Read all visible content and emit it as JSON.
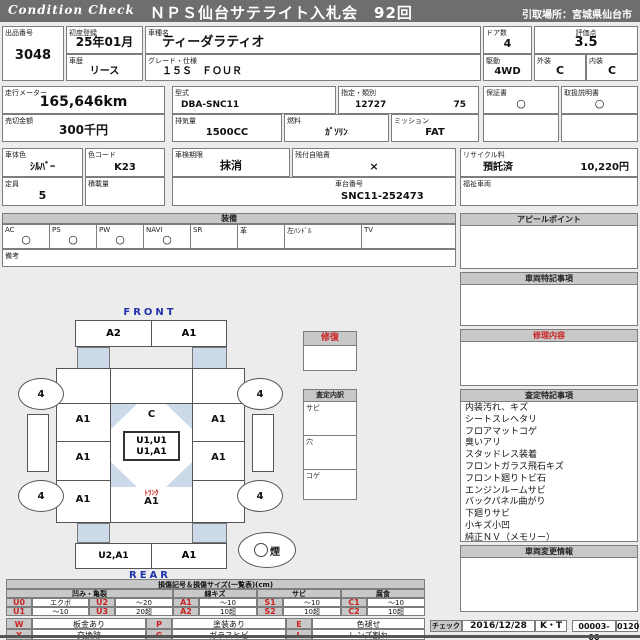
{
  "header": {
    "logo": "Condition Check",
    "title": "ＮＰＳ仙台サテライト入札会　92回",
    "pickup": "引取場所：宮城県仙台市"
  },
  "fields": {
    "lot_no": {
      "label": "出品番号",
      "value": "3048"
    },
    "first_registration": {
      "label": "初度登録",
      "value": "25年01月"
    },
    "car_history": {
      "label": "車歴",
      "value": "リース"
    },
    "model_name": {
      "label": "車種名",
      "value": "ティーダラティオ"
    },
    "grade": {
      "label": "グレード・仕様",
      "value": "１５Ｓ　ＦＯＵＲ"
    },
    "doors": {
      "label": "ドア数",
      "value": "4"
    },
    "score": {
      "label": "評価点",
      "value": "3.5"
    },
    "drive": {
      "label": "駆動",
      "value": "4WD"
    },
    "exterior_grade": {
      "label": "外装",
      "value": "C"
    },
    "interior_grade": {
      "label": "内装",
      "value": "C"
    },
    "odometer": {
      "label": "走行メーター",
      "value": "165,646km"
    },
    "sellout_price": {
      "label": "売切金額",
      "value": "300千円"
    },
    "model_code": {
      "label": "型式",
      "value": "DBA-SNC11"
    },
    "class_no": {
      "label": "指定・類別",
      "designation": "12727",
      "class": "75"
    },
    "warranty_book": {
      "label": "保証書",
      "value": "○"
    },
    "owners_manual": {
      "label": "取扱説明書",
      "value": "○"
    },
    "displacement": {
      "label": "排気量",
      "value": "1500CC"
    },
    "fuel": {
      "label": "燃料",
      "value": "ｶﾞｿﾘﾝ"
    },
    "transmission": {
      "label": "ミッション",
      "value": "FAT"
    },
    "body_color": {
      "label": "車体色",
      "value": "ｼﾙﾊﾞｰ"
    },
    "color_code": {
      "label": "色コード",
      "value": "K23"
    },
    "inspection_expiry": {
      "label": "車検期限",
      "value": "抹消"
    },
    "liability_insurance": {
      "label": "残付自賠責",
      "value": "×"
    },
    "seating": {
      "label": "定員",
      "value": "5"
    },
    "load_capacity": {
      "label": "積載量",
      "value": ""
    },
    "chassis_no": {
      "label": "車台番号",
      "value": "SNC11-252473"
    },
    "recycle_fee": {
      "label": "リサイクル料",
      "status": "預託済",
      "value": "10,220円"
    },
    "welfare_vehicle": {
      "label": "福祉車両",
      "value": ""
    }
  },
  "equipment": {
    "title": "装備",
    "remarks_label": "備考",
    "items": [
      {
        "label": "AC",
        "value": "○"
      },
      {
        "label": "PS",
        "value": "○"
      },
      {
        "label": "PW",
        "value": "○"
      },
      {
        "label": "NAVI",
        "value": "○"
      },
      {
        "label": "SR",
        "value": ""
      },
      {
        "label": "革",
        "value": ""
      },
      {
        "label": "左ﾊﾝﾄﾞﾙ",
        "value": ""
      },
      {
        "label": "TV",
        "value": ""
      }
    ]
  },
  "sections": {
    "appeal": {
      "title": "アピールポイント",
      "body": ""
    },
    "vehicle_notes": {
      "title": "車両特記事項",
      "body": ""
    },
    "repair": {
      "title": "修理内容",
      "body": ""
    },
    "assessment": {
      "title": "査定特記事項",
      "lines": [
        "内装汚れ、キズ",
        "シートスレヘタリ",
        "フロアマットコゲ",
        "臭いアリ",
        "スタッドレス装着",
        "フロントガラス飛石キズ",
        "フロント廻りトビ石",
        "エンジンルームサビ",
        "バックパネル曲がり",
        "下廻りサビ",
        "小キズ小凹",
        "純正ＮＶ（メモリー）"
      ]
    },
    "change_info": {
      "title": "車両変更情報",
      "body": ""
    },
    "repair_history": {
      "title": "修復"
    },
    "assessment_detail": {
      "title": "査定内訳",
      "rows": [
        "サビ",
        "穴",
        "コゲ"
      ]
    }
  },
  "diagram": {
    "front_label": "FRONT",
    "rear_label": "REAR",
    "front_bumper_left": "A2",
    "front_bumper_right": "A1",
    "tire_front_left": "4",
    "tire_front_right": "4",
    "tire_rear_left": "4",
    "tire_rear_right": "4",
    "left_panels": [
      "A1",
      "A1",
      "A1"
    ],
    "right_panels": [
      "A1",
      "A1"
    ],
    "roof": "C",
    "center_line1": "U1,U1",
    "center_line2": "U1,A1",
    "trunk_label": "ﾄﾗﾝｸ",
    "trunk_mark": "A1",
    "rear_bumper_left": "U2,A1",
    "rear_bumper_right": "A1",
    "smoke_mark": "煙"
  },
  "damage_table": {
    "title": "損傷記号＆損傷サイズ(一覧表)(cm)",
    "groups": [
      {
        "name": "凹み・亀裂",
        "rows": [
          [
            "U0",
            "エクボ",
            "U2",
            "〜20"
          ],
          [
            "U1",
            "〜10",
            "U3",
            "20超"
          ]
        ]
      },
      {
        "name": "線キズ",
        "rows": [
          [
            "A1",
            "〜10"
          ],
          [
            "A2",
            "10超"
          ]
        ]
      },
      {
        "name": "サビ",
        "rows": [
          [
            "S1",
            "〜10"
          ],
          [
            "S2",
            "10超"
          ]
        ]
      },
      {
        "name": "腐食",
        "rows": [
          [
            "C1",
            "〜10"
          ],
          [
            "C2",
            "10超"
          ]
        ]
      }
    ],
    "legend": [
      [
        {
          "code": "W",
          "text": "板金あり"
        },
        {
          "code": "P",
          "text": "塗装あり"
        },
        {
          "code": "E",
          "text": "色褪せ"
        }
      ],
      [
        {
          "code": "X",
          "text": "交換跡"
        },
        {
          "code": "G",
          "text": "ガラスヒビ"
        },
        {
          "code": "L",
          "text": "レンズ割れ"
        }
      ]
    ]
  },
  "check": {
    "label": "チェック",
    "date": "2016/12/28",
    "inspector": "K・T",
    "doc_no": "00003-00",
    "page_code": "0120"
  },
  "colors": {
    "accent_red": "#cc2222",
    "label_blue": "#2233aa",
    "header_gray": "#c8c8c8",
    "titlebar_gray": "#6e6e6e",
    "glass_blue": "#ccd9e8"
  }
}
